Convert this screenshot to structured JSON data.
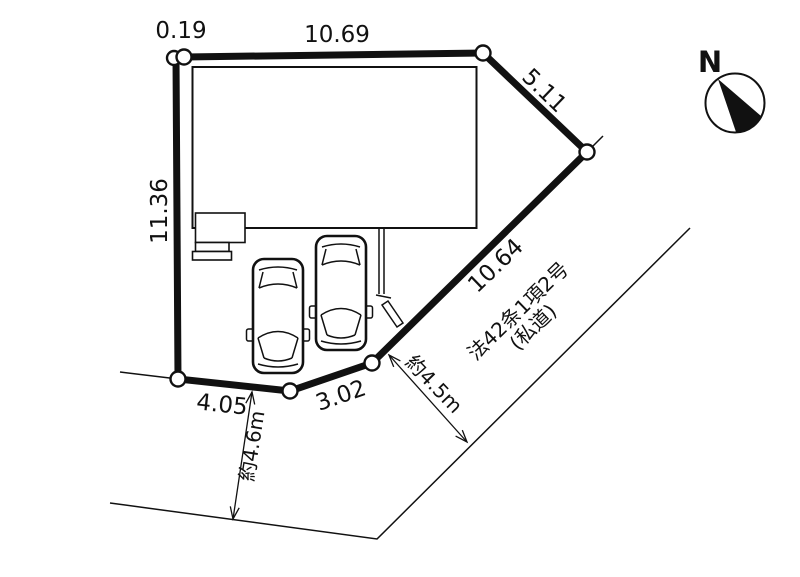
{
  "colors": {
    "background": "#ffffff",
    "ink": "#111111"
  },
  "compass": {
    "north_label": "N"
  },
  "lot": {
    "boundary_lengths": {
      "top_left": "0.19",
      "top": "10.69",
      "left": "11.36",
      "upper_right": "5.11",
      "lower_right": "10.64",
      "bottom_right": "3.02",
      "bottom_left": "4.05"
    }
  },
  "roads": {
    "private_road": {
      "designation": "法42条1項2号",
      "kind": "(私道)",
      "width": "約4.5m"
    },
    "front_road": {
      "width": "約4.6m"
    }
  }
}
